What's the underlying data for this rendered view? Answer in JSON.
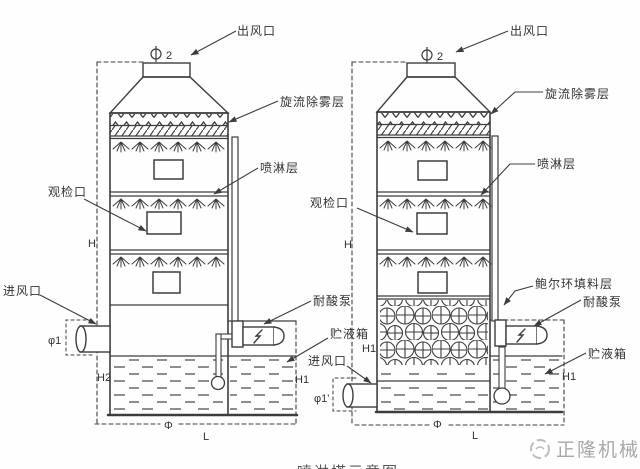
{
  "colors": {
    "line": "#3d3d3d",
    "label": "#333333",
    "watermark": "#a8a8a8",
    "background": "#fefefe"
  },
  "caption": {
    "text": "喷淋塔示意图"
  },
  "watermark": {
    "text": "正隆机械"
  },
  "left": {
    "outlet": "出风口",
    "demister": "旋流除雾层",
    "spray": "喷淋层",
    "inspection": "观检口",
    "inlet": "进风口",
    "pump": "耐酸泵",
    "tank": "贮液箱",
    "dims": {
      "h": "H",
      "h1": "H1",
      "h2": "H2",
      "phi": "Φ",
      "l": "L",
      "phi1": "φ1",
      "phi2_num": "2"
    }
  },
  "right": {
    "outlet": "出风口",
    "demister": "旋流除雾层",
    "spray": "喷淋层",
    "inspection": "观检口",
    "packing": "鲍尔环填料层",
    "pump": "耐酸泵",
    "tank": "贮液箱",
    "inlet": "进风口",
    "dims": {
      "h": "H",
      "h1_left": "H1",
      "h1_right": "H1",
      "phi": "Φ",
      "l": "L",
      "phi1": "φ1'",
      "phi2_num": "2"
    }
  }
}
